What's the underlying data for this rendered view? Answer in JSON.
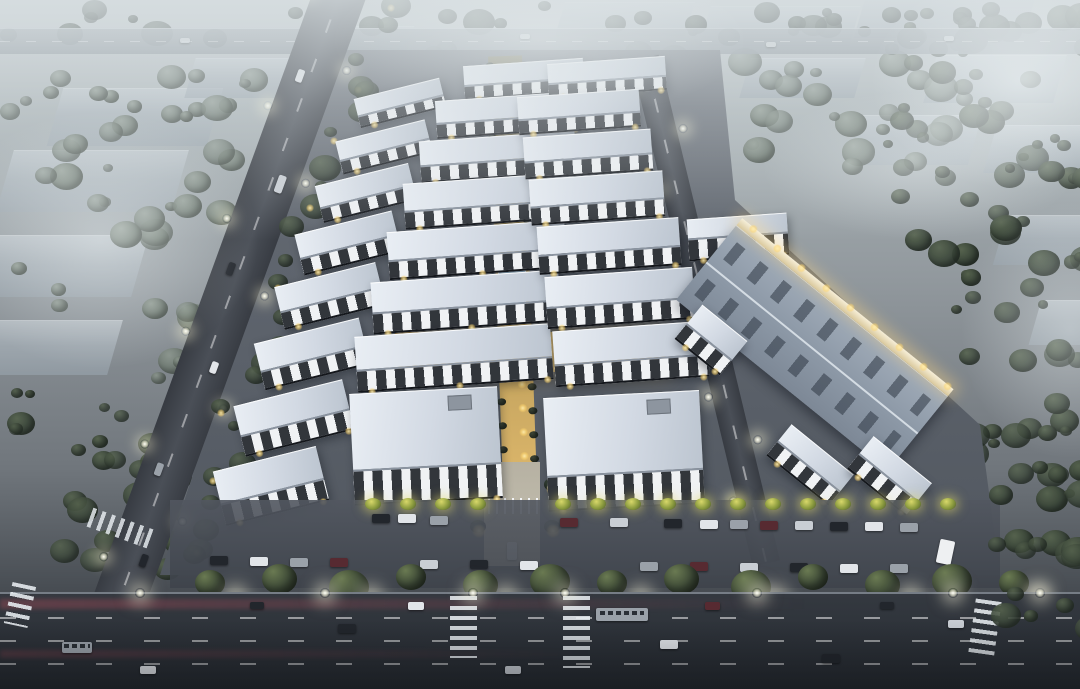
{
  "scene": {
    "type": "architectural-aerial-rendering",
    "subject": "industrial-park-business-campus",
    "time_of_day": "dusk",
    "visible_text": "none"
  },
  "palette": {
    "haze": "#dde3e5",
    "roof_light": "#e9eef4",
    "roof_mid": "#ccd4de",
    "roof_edge": "#8b94a0",
    "wall_white": "#eceef1",
    "window_dark": "#23272e",
    "warehouse_roof": "#8d99a7",
    "warehouse_rib": "#39424f",
    "ground": "#5d636c",
    "road": "#3f444b",
    "asphalt": "#2e333a",
    "axis_gold": "#d9b469",
    "axis_deep": "#8a7442",
    "pool_blue": "#7ba3bd",
    "walk": "#b6b1a2",
    "tree_dark_hi": "#55624d",
    "tree_dark_lo": "#323d33",
    "tree_gray_hi": "#8d988e",
    "tree_gray_lo": "#5e6a60",
    "forest_hi": "#3f4b3e",
    "forest_lo": "#242e26",
    "lamp_warm": "#ffd978",
    "lamp_white": "#fffbe8",
    "red_streak": "rgba(205,80,95,0.30)",
    "car_colors": [
      "#22262c",
      "#e2e5e9",
      "#9aa1a9",
      "#572a31",
      "#c9ced4"
    ]
  },
  "distant": {
    "left": [
      [
        55,
        88,
        160,
        58
      ],
      [
        5,
        150,
        175,
        62
      ],
      [
        -20,
        235,
        160,
        62
      ],
      [
        -15,
        320,
        130,
        55
      ],
      [
        190,
        58,
        120,
        40
      ],
      [
        300,
        26,
        110,
        30
      ]
    ],
    "right": [
      [
        560,
        2,
        130,
        34
      ],
      [
        705,
        6,
        150,
        40
      ],
      [
        860,
        -6,
        170,
        44
      ],
      [
        930,
        55,
        130,
        48
      ],
      [
        990,
        125,
        95,
        48
      ],
      [
        855,
        115,
        120,
        50
      ],
      [
        745,
        58,
        115,
        40
      ],
      [
        1000,
        215,
        90,
        50
      ],
      [
        1035,
        300,
        60,
        45
      ]
    ]
  },
  "vegetation": {
    "bands": [
      {
        "x": 0,
        "y": 0,
        "w": 1080,
        "h": 30,
        "n": 40,
        "tone": "forest",
        "late": false
      },
      {
        "x": 0,
        "y": 60,
        "w": 250,
        "h": 330,
        "n": 58,
        "tone": "gray",
        "late": false
      },
      {
        "x": 0,
        "y": 380,
        "w": 200,
        "h": 185,
        "n": 30,
        "tone": "dark",
        "late": false
      },
      {
        "x": 380,
        "y": 40,
        "w": 360,
        "h": 28,
        "n": 16,
        "tone": "gray",
        "late": false
      },
      {
        "x": 740,
        "y": 30,
        "w": 220,
        "h": 130,
        "n": 26,
        "tone": "gray",
        "late": false
      },
      {
        "x": 880,
        "y": 0,
        "w": 200,
        "h": 250,
        "n": 46,
        "tone": "dark",
        "late": false
      },
      {
        "x": 950,
        "y": 240,
        "w": 130,
        "h": 300,
        "n": 34,
        "tone": "dark",
        "late": false
      },
      {
        "x": 985,
        "y": 455,
        "w": 95,
        "h": 165,
        "n": 16,
        "tone": "dark",
        "late": true
      }
    ],
    "roadside_count": 26
  },
  "roads": {
    "top": {
      "y": 28,
      "h": 26,
      "vehicles": [
        [
          180,
          38
        ],
        [
          520,
          34
        ],
        [
          766,
          42
        ],
        [
          944,
          36
        ]
      ]
    },
    "left": {
      "x": 319,
      "y": -20,
      "w": 52,
      "len": 760,
      "angle": 20,
      "lamps": 12,
      "vehicles": [
        {
          "t": 0.13,
          "o": -10,
          "w": 7,
          "h": 13,
          "c": 1
        },
        {
          "t": 0.27,
          "o": 8,
          "w": 8,
          "h": 18,
          "c": 4
        },
        {
          "t": 0.4,
          "o": -9,
          "w": 7,
          "h": 13,
          "c": 0
        },
        {
          "t": 0.53,
          "o": 9,
          "w": 7,
          "h": 12,
          "c": 1
        },
        {
          "t": 0.68,
          "o": -8,
          "w": 7,
          "h": 13,
          "c": 2
        },
        {
          "t": 0.8,
          "o": 9,
          "w": 7,
          "h": 13,
          "c": 0
        }
      ]
    },
    "internal": {
      "x": 631,
      "y": 58,
      "w": 28,
      "len": 520,
      "angle": -13.5,
      "lamps": 9
    },
    "boulevard": {
      "y": 592,
      "h": 97,
      "lane_ys": [
        615,
        638,
        661
      ],
      "crosswalks": [
        {
          "x": 450,
          "y": 596,
          "w": 27,
          "h": 62,
          "r": 0,
          "horiz": false
        },
        {
          "x": 563,
          "y": 596,
          "w": 27,
          "h": 72,
          "r": 0,
          "horiz": false
        },
        {
          "x": 8,
          "y": 584,
          "w": 24,
          "h": 42,
          "r": 12,
          "horiz": false
        },
        {
          "x": 88,
          "y": 518,
          "w": 64,
          "h": 20,
          "r": 20,
          "horiz": true
        },
        {
          "x": 972,
          "y": 600,
          "w": 26,
          "h": 54,
          "r": 8,
          "horiz": false
        }
      ],
      "streaks": [
        {
          "y": 597,
          "h": 10,
          "a": 0.3,
          "wf": 0.75
        },
        {
          "y": 648,
          "h": 8,
          "a": 0.2,
          "wf": 0.55
        }
      ],
      "vehicles": [
        {
          "x": 596,
          "y": 606,
          "w": 52,
          "h": 13,
          "c": 2,
          "bus": true
        },
        {
          "x": 338,
          "y": 622,
          "w": 18,
          "h": 9,
          "c": 0,
          "bus": false
        },
        {
          "x": 408,
          "y": 600,
          "w": 16,
          "h": 8,
          "c": 1,
          "bus": false
        },
        {
          "x": 660,
          "y": 638,
          "w": 18,
          "h": 9,
          "c": 1,
          "bus": false
        },
        {
          "x": 822,
          "y": 652,
          "w": 18,
          "h": 9,
          "c": 0,
          "bus": false
        },
        {
          "x": 948,
          "y": 618,
          "w": 16,
          "h": 8,
          "c": 4,
          "bus": false
        },
        {
          "x": 62,
          "y": 640,
          "w": 30,
          "h": 11,
          "c": 2,
          "bus": true
        },
        {
          "x": 140,
          "y": 664,
          "w": 16,
          "h": 8,
          "c": 1,
          "bus": false
        },
        {
          "x": 250,
          "y": 600,
          "w": 14,
          "h": 7,
          "c": 0,
          "bus": false
        },
        {
          "x": 705,
          "y": 600,
          "w": 15,
          "h": 8,
          "c": 3,
          "bus": false
        },
        {
          "x": 505,
          "y": 664,
          "w": 16,
          "h": 8,
          "c": 4,
          "bus": false
        },
        {
          "x": 880,
          "y": 600,
          "w": 14,
          "h": 7,
          "c": 0,
          "bus": false
        }
      ],
      "lamps": [
        135,
        320,
        468,
        560,
        752,
        948,
        1035
      ]
    }
  },
  "campus": {
    "ground_poly": [
      [
        335,
        50
      ],
      [
        720,
        50
      ],
      [
        735,
        200
      ],
      [
        980,
        425
      ],
      [
        1000,
        575
      ],
      [
        160,
        575
      ],
      [
        245,
        315
      ]
    ],
    "axis": {
      "x": 488,
      "y": 56,
      "w": 34,
      "len": 410,
      "angle": -2
    },
    "pool": {
      "x": 498,
      "y": 270,
      "w": 28,
      "h": 36
    },
    "plaza": {
      "x": 395,
      "y": 332,
      "w": 270,
      "h": 40
    },
    "entrance": {
      "x": 484,
      "y": 462,
      "w": 56,
      "h": 104,
      "gate_y": 498
    },
    "buildings": {
      "left_road_column": {
        "angle": -14,
        "rows": [
          [
            356,
            88,
            88,
            30
          ],
          [
            338,
            130,
            92,
            34
          ],
          [
            318,
            174,
            96,
            38
          ],
          [
            298,
            222,
            100,
            42
          ],
          [
            278,
            274,
            104,
            44
          ],
          [
            258,
            330,
            108,
            48
          ],
          [
            238,
            392,
            112,
            52
          ],
          [
            218,
            458,
            106,
            56
          ]
        ]
      },
      "central_left": {
        "angle": -4,
        "rows": [
          [
            464,
            62,
            120,
            34
          ],
          [
            436,
            96,
            144,
            38
          ],
          [
            420,
            136,
            156,
            42
          ],
          [
            404,
            178,
            168,
            46
          ],
          [
            388,
            226,
            178,
            48
          ],
          [
            372,
            276,
            188,
            52
          ],
          [
            356,
            330,
            196,
            56
          ]
        ]
      },
      "central_right": {
        "angle": -4,
        "rows": [
          [
            548,
            60,
            118,
            34
          ],
          [
            518,
            93,
            122,
            38
          ],
          [
            524,
            133,
            128,
            42
          ],
          [
            530,
            175,
            134,
            46
          ],
          [
            538,
            222,
            142,
            48
          ],
          [
            546,
            272,
            148,
            52
          ],
          [
            554,
            326,
            154,
            56
          ]
        ]
      },
      "front": {
        "angle": -3,
        "blocks": [
          [
            352,
            390,
            148,
            112
          ],
          [
            546,
            394,
            156,
            114
          ]
        ]
      },
      "office": {
        "x": 688,
        "y": 216,
        "w": 100,
        "h": 42,
        "angle": -4
      },
      "warehouse": {
        "cx": 812,
        "cy": 348,
        "len": 272,
        "wid": 96,
        "angle": 39
      },
      "annexes": {
        "angle": 39,
        "blocks": [
          [
            682,
            318,
            58,
            44
          ],
          [
            770,
            445,
            80,
            40
          ],
          [
            852,
            455,
            75,
            42
          ]
        ]
      }
    },
    "parking": {
      "band": {
        "x": 170,
        "y": 500,
        "w": 830,
        "h": 88
      },
      "cars_row1": [
        [
          372,
          514
        ],
        [
          398,
          514
        ],
        [
          430,
          516
        ],
        [
          560,
          518
        ],
        [
          610,
          518
        ],
        [
          664,
          519
        ],
        [
          700,
          520
        ],
        [
          730,
          520
        ],
        [
          760,
          521
        ],
        [
          795,
          521
        ],
        [
          830,
          522
        ],
        [
          865,
          522
        ],
        [
          900,
          523
        ]
      ],
      "cars_row2": [
        [
          210,
          556
        ],
        [
          250,
          557
        ],
        [
          290,
          558
        ],
        [
          330,
          558
        ],
        [
          420,
          560
        ],
        [
          470,
          560
        ],
        [
          520,
          561
        ],
        [
          640,
          562
        ],
        [
          690,
          562
        ],
        [
          740,
          563
        ],
        [
          790,
          563
        ],
        [
          840,
          564
        ],
        [
          890,
          564
        ]
      ],
      "shrub_xs": [
        365,
        400,
        435,
        470,
        555,
        590,
        625,
        660,
        695,
        730,
        765,
        800,
        835,
        870,
        905,
        940
      ],
      "van": {
        "x": 938,
        "y": 540,
        "w": 15,
        "h": 24,
        "angle": 12
      }
    },
    "street_trees": {
      "y": 570,
      "xs": [
        195,
        262,
        329,
        396,
        463,
        530,
        597,
        664,
        731,
        798,
        865,
        932,
        999
      ]
    },
    "street_lamps": {
      "y": 592,
      "xs": [
        230,
        365,
        500,
        635,
        770,
        905,
        1030
      ]
    }
  },
  "fx": {
    "fogs": [
      {
        "x": 870,
        "y": -30,
        "w": 300,
        "h": 220,
        "a": 0.75
      },
      {
        "x": 960,
        "y": 200,
        "w": 220,
        "h": 260,
        "a": 0.42
      },
      {
        "x": -60,
        "y": 110,
        "w": 320,
        "h": 260,
        "a": 0.5
      },
      {
        "x": 760,
        "y": 90,
        "w": 320,
        "h": 150,
        "a": 0.45
      },
      {
        "x": 330,
        "y": -40,
        "w": 420,
        "h": 160,
        "a": 0.45
      }
    ]
  }
}
